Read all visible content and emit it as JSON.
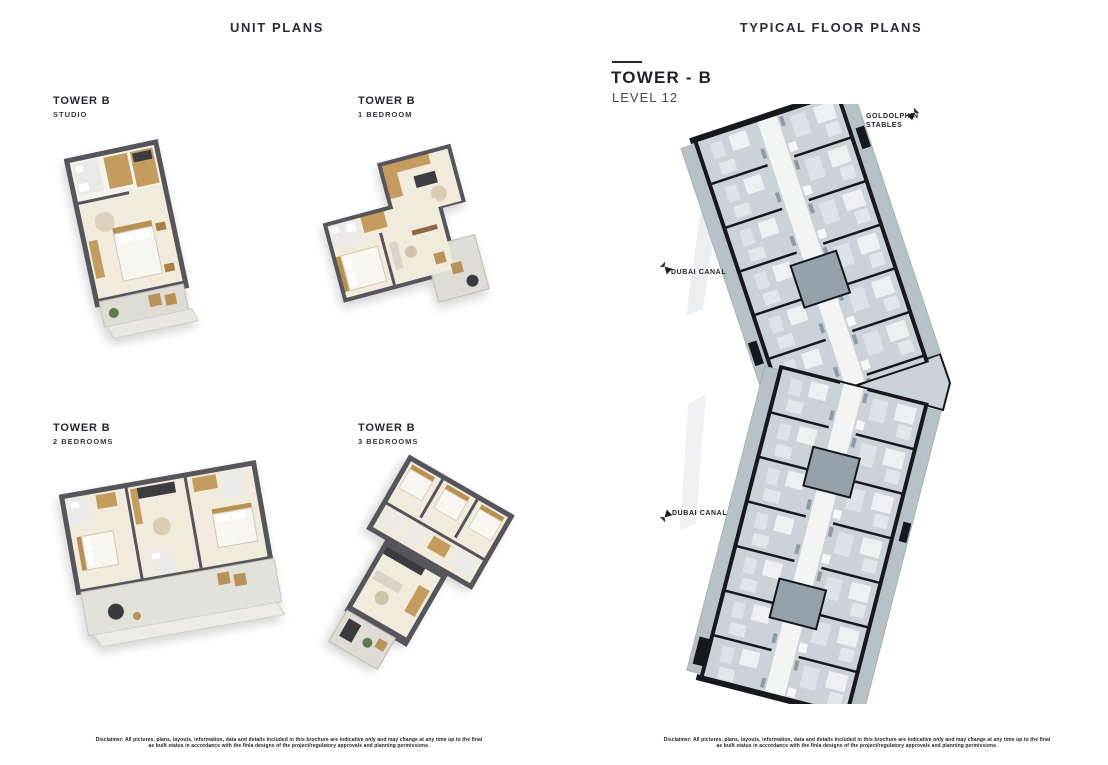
{
  "headers": {
    "left": "UNIT PLANS",
    "right": "TYPICAL FLOOR PLANS"
  },
  "tower_block": {
    "title": "TOWER - B",
    "level": "LEVEL 12"
  },
  "unit_plans": [
    {
      "tower": "TOWER B",
      "type": "STUDIO"
    },
    {
      "tower": "TOWER B",
      "type": "1 BEDROOM"
    },
    {
      "tower": "TOWER B",
      "type": "2 BEDROOMS"
    },
    {
      "tower": "TOWER B",
      "type": "3 BEDROOMS"
    }
  ],
  "map_annotations": {
    "stables_line1": "GOLDOLPHIN",
    "stables_line2": "STABLES",
    "canal_upper": "DUBAI CANAL",
    "canal_lower": "DUBAI CANAL"
  },
  "disclaimer": "Disclaimer: All pictures, plans, layouts, information, data and details included in this brochure are indicative only and may change at any time up to the final as built status in accordance with the finla designs of the project/regulatory approvals and planning permissions.",
  "colors": {
    "text_dark": "#26282e",
    "render_wall": "#55555b",
    "render_floor_cream": "#f1ebdd",
    "render_wood": "#c49c5e",
    "plan_room_fill": "#cbd3d9",
    "plan_balcony_fill": "#b6c1c8",
    "plan_wall_black": "#17181c"
  }
}
